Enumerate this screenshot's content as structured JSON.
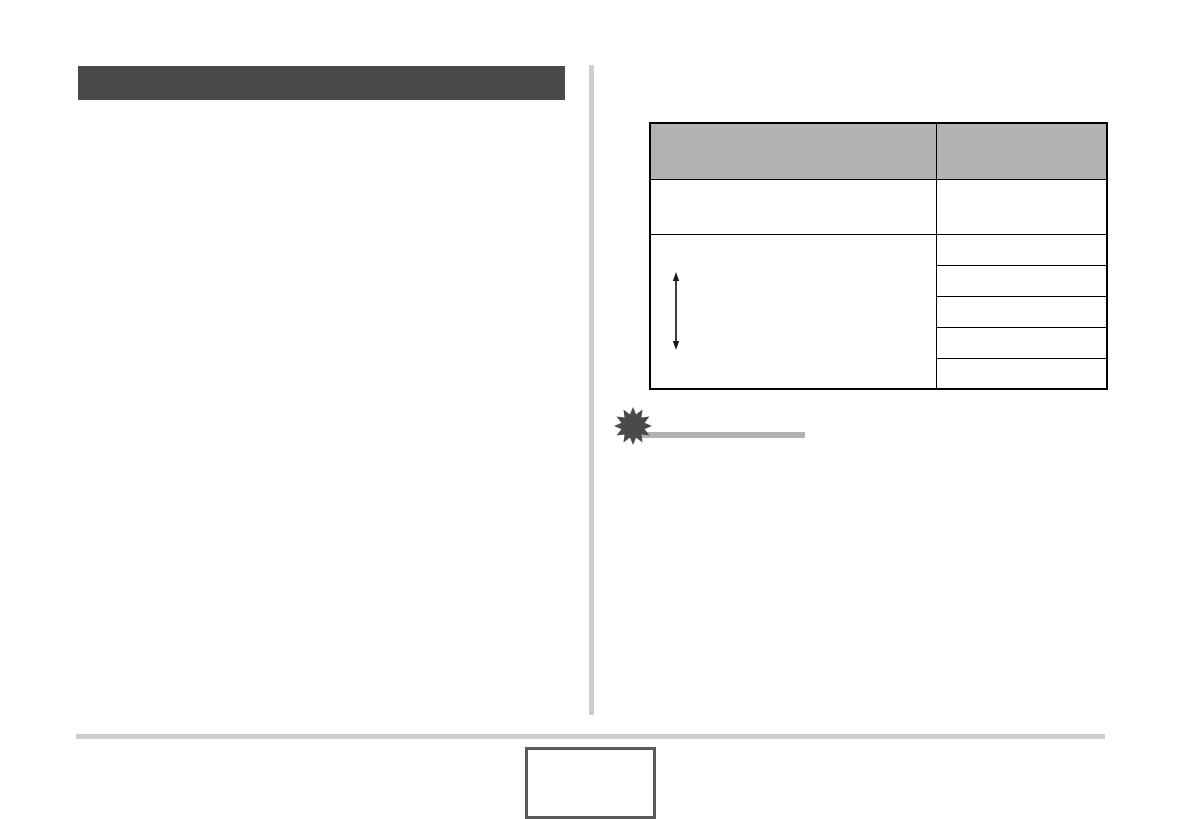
{
  "section_header": {
    "label": ""
  },
  "table": {
    "header": [
      "",
      ""
    ],
    "row1": {
      "left": "",
      "right": ""
    },
    "row2": {
      "left": "",
      "left_icon": "vertical-double-arrow-icon",
      "right_cells": [
        "",
        "",
        "",
        "",
        ""
      ]
    }
  },
  "important_note": {
    "icon": "starburst-icon",
    "heading": ""
  },
  "footer": {
    "page_number": ""
  },
  "colors": {
    "section_header_bar": "#4a4a4a",
    "column_divider": "#cdcdcd",
    "table_header_fill": "#b2b2b2",
    "table_border": "#000000",
    "starburst": "#4a4a4a",
    "important_rule": "#b2b2b2",
    "footer_rule": "#cdcdcd",
    "page_number_box_border": "#5a5a5a",
    "page_background": "#ffffff"
  }
}
